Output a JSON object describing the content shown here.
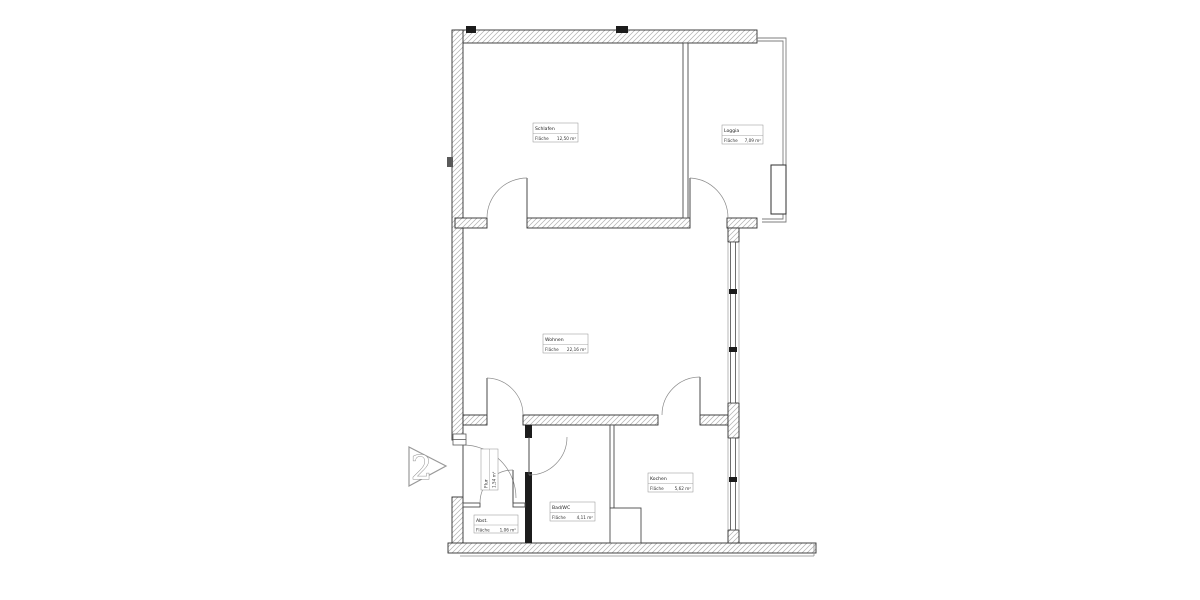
{
  "plan": {
    "unit_marker": "2",
    "rooms": [
      {
        "id": "schlafen",
        "name": "Schlafen",
        "area_label": "Fläche",
        "area_value": "12,50 m²"
      },
      {
        "id": "loggia",
        "name": "Loggia",
        "area_label": "Fläche",
        "area_value": "7,09 m²"
      },
      {
        "id": "wohnen",
        "name": "Wohnen",
        "area_label": "Fläche",
        "area_value": "22,16 m²"
      },
      {
        "id": "kochen",
        "name": "Kochen",
        "area_label": "Fläche",
        "area_value": "5,62 m²"
      },
      {
        "id": "badwc",
        "name": "Bad/WC",
        "area_label": "Fläche",
        "area_value": "4,11 m²"
      },
      {
        "id": "abstell",
        "name": "Abst.",
        "area_label": "Fläche",
        "area_value": "1,06 m²"
      },
      {
        "id": "flur",
        "name": "Flur",
        "area_label": "Fläche",
        "area_value": "1,54 m²"
      }
    ],
    "colors": {
      "wall_outline": "#2f2f2f",
      "hatch_line": "#b0b0b0",
      "poche_fill": "#1c1c1c",
      "thin_line": "#6a6a6a",
      "door_arc": "#8a8a8a",
      "background": "#ffffff"
    }
  }
}
